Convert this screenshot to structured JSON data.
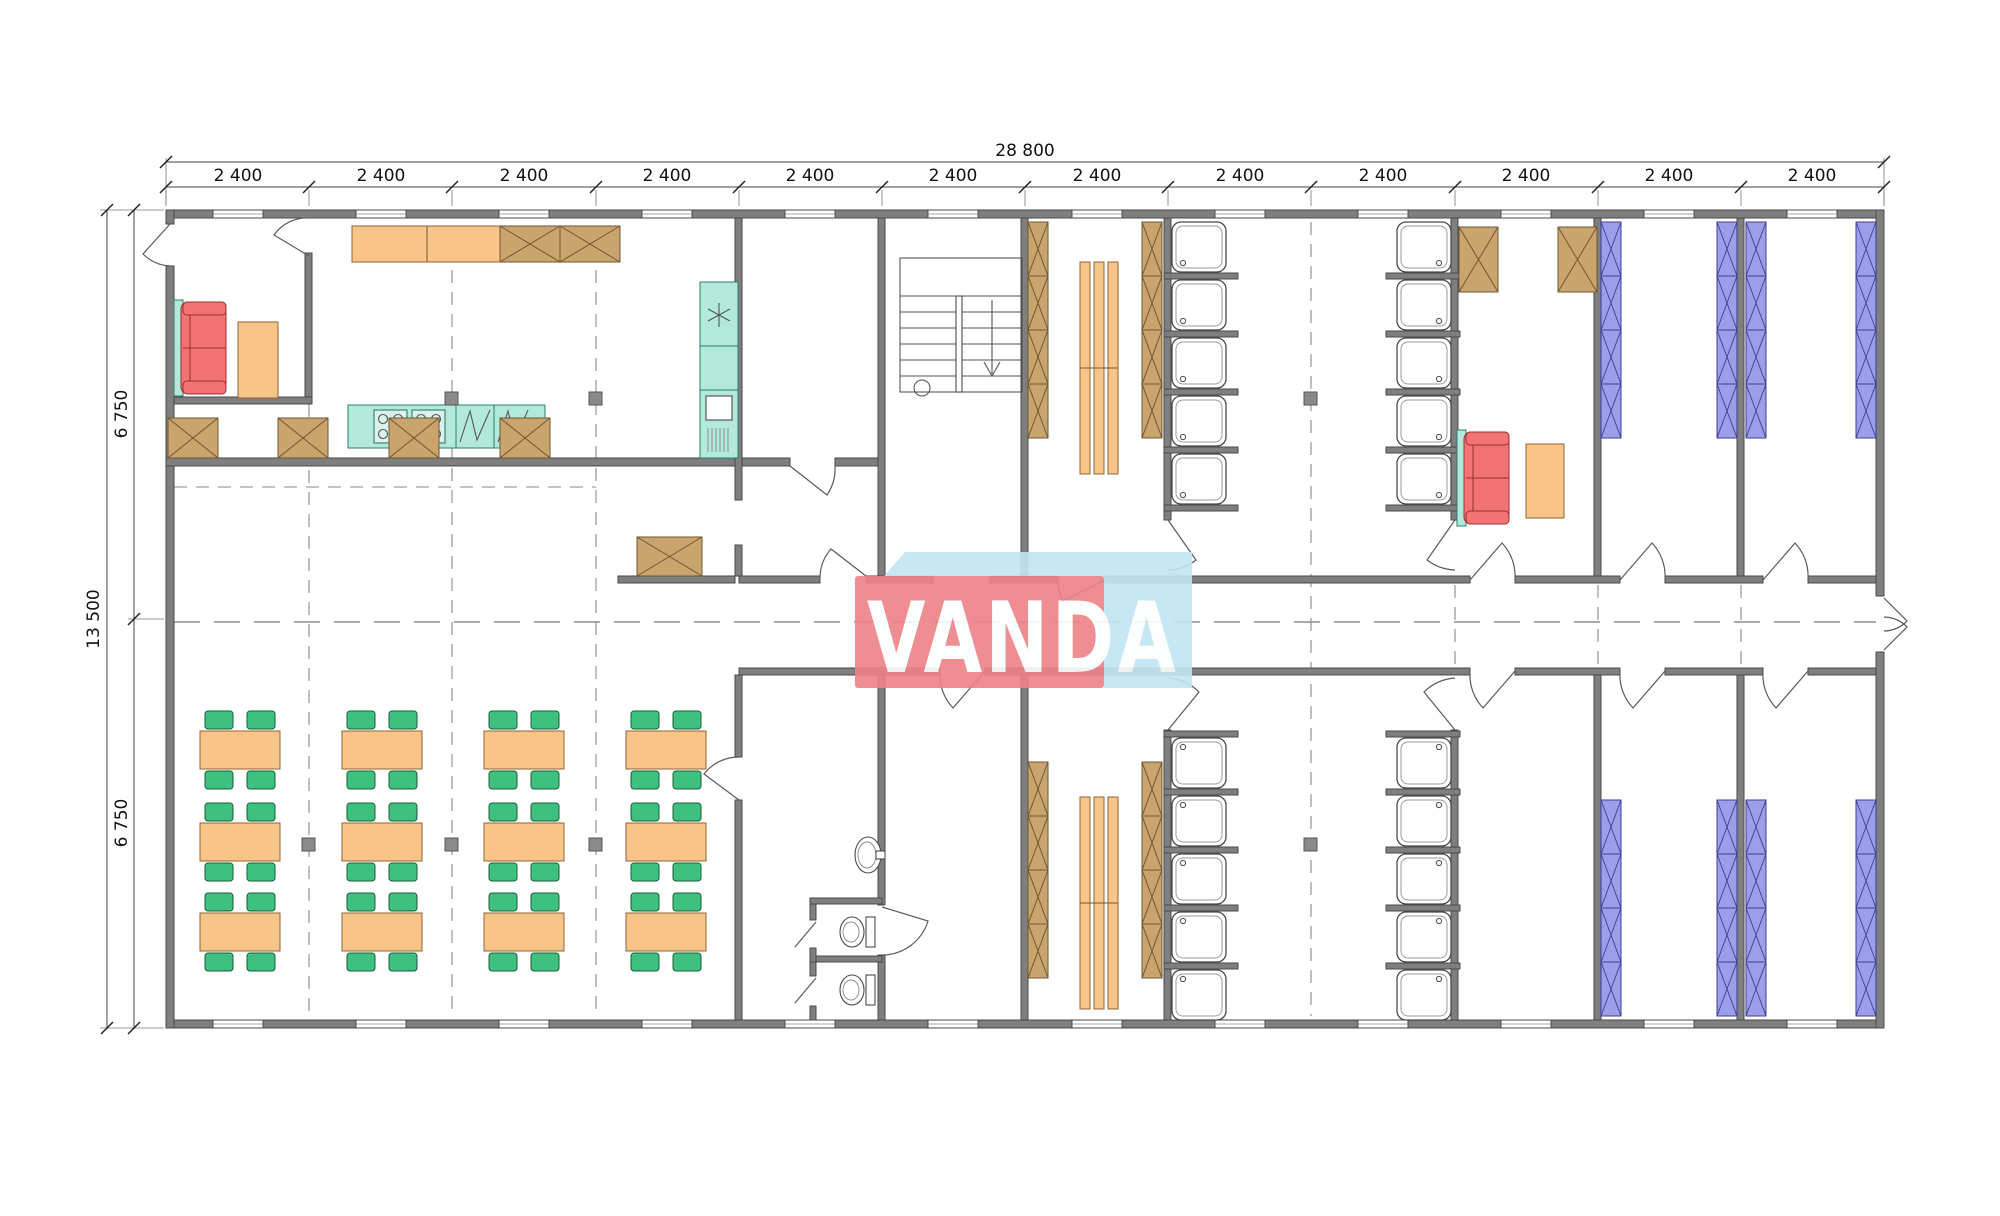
{
  "page": {
    "background": "#ffffff",
    "description": "Architectural floor plan of a modular accommodation building with dining hall, kitchen, stairwell, WC, shower and changing rooms, and bunk bedrooms"
  },
  "palette": {
    "wall_fill": "#7f7f7f",
    "wall_edge": "#4a4a4a",
    "line": "#555555",
    "dash_line": "#787878",
    "wood": "#c9a46c",
    "wood_edge": "#6e5733",
    "furniture_orange": "#f9c488",
    "chair_green": "#3ec07e",
    "kitchen_teal": "#b2e9db",
    "sofa_red": "#f17373",
    "bunk_blue": "#9c9ee9",
    "fixture_white": "#ffffff",
    "dim_text": "#111111",
    "logo_red": "#ed8287",
    "logo_blue": "#c3e5f5",
    "logo_text": "#ffffff"
  },
  "dimensions": {
    "overall_width": "28 800",
    "overall_height": "13 500",
    "bay_width_labels": [
      "2 400",
      "2 400",
      "2 400",
      "2 400",
      "2 400",
      "2 400",
      "2 400",
      "2 400",
      "2 400",
      "2 400",
      "2 400",
      "2 400"
    ],
    "height_segment_labels": [
      "6 750",
      "6 750"
    ]
  },
  "logo": {
    "text": "VANDA"
  },
  "inventory": {
    "dining_table_sets": 12,
    "chairs": 48,
    "shower_stalls": 20,
    "toilets": 2,
    "washbasins": 1,
    "sofas": 2,
    "coffee_tables": 2,
    "bunk_bed_runs": 8,
    "locker_runs": 4,
    "changing_benches": 2,
    "cooktops": 2,
    "sink_bowls": 2,
    "refrigerators": 1,
    "staircases": 1,
    "windows": 24,
    "wardrobe_cabinets": 9
  }
}
